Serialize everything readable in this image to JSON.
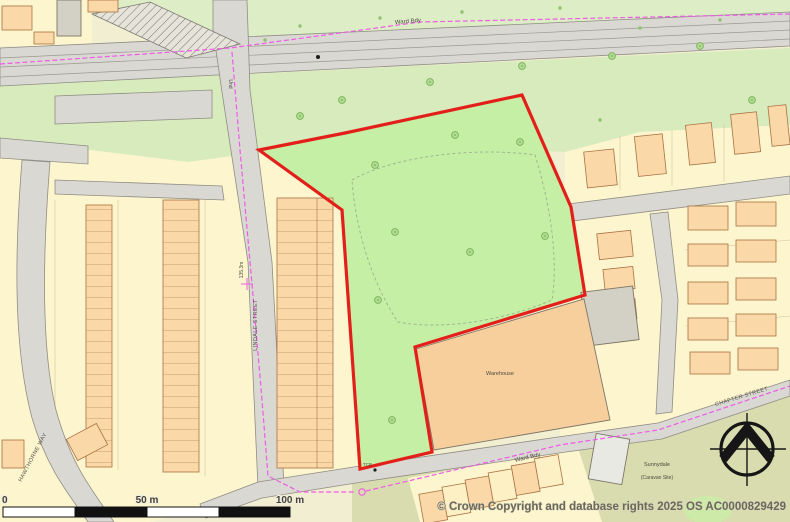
{
  "map": {
    "attribution": "© Crown Copyright and database rights 2025 OS AC0000829429",
    "scale_bar": {
      "tick_0": "0",
      "tick_50": "50 m",
      "tick_100": "100 m"
    },
    "labels": {
      "ward_bdy_top": "Ward Bdy",
      "ward_bdy_bottom": "Ward Bdy",
      "und": "Und",
      "spot_height": "135.3m",
      "lindale_street": "LINDALE STREET",
      "chapter_street": "CHAPTER STREET",
      "hawthorne_way": "HAWTHORNE WAY",
      "warehouse": "Warehouse",
      "sunnydale_line1": "Sunnydale",
      "sunnydale_line2": "(Caravan Site)",
      "tcb": "TCB"
    },
    "colors": {
      "site_boundary_red": "#e31f1a",
      "ward_boundary_magenta": "#ee5ce6",
      "site_field_green": "#c6efa6",
      "verge_green": "#d8ebbd",
      "building_peach": "#fbd8a8",
      "warehouse_fill": "#f7cf9c",
      "road_gray": "#dad8d3",
      "parcel_yellow": "#fdf5cd"
    }
  }
}
